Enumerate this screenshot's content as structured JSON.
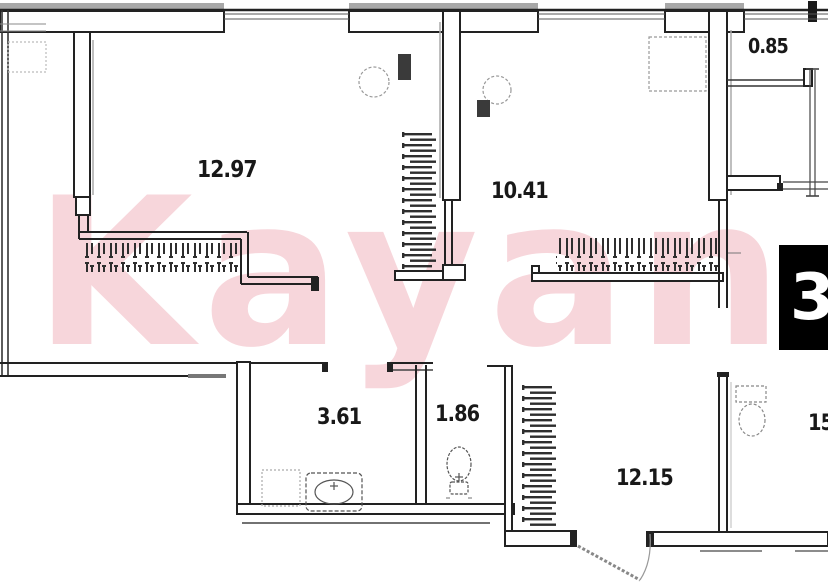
{
  "watermark": {
    "text": "Kayan",
    "color": "#f7d6db"
  },
  "unit_badge": {
    "value": "3",
    "bg": "#000000",
    "fg": "#ffffff"
  },
  "rooms": [
    {
      "id": "room-top-left",
      "area": "12.97"
    },
    {
      "id": "room-top-middle",
      "area": "10.41"
    },
    {
      "id": "balcony-top-right",
      "area": "0.85"
    },
    {
      "id": "bathroom",
      "area": "3.61"
    },
    {
      "id": "wc",
      "area": "1.86"
    },
    {
      "id": "hallway",
      "area": "12.15"
    },
    {
      "id": "room-right-cropped",
      "area": "15"
    }
  ],
  "symbols": [
    "wardrobe-hatch",
    "toilet-symbol",
    "sink-symbol",
    "washer-symbol",
    "door-swing-symbol",
    "window-lines",
    "wall-pier"
  ],
  "colors": {
    "wall": "#222222",
    "hatch": "#2e2e2e",
    "fixture": "#8a8a8a",
    "shadow": "#aaaaaa",
    "watermark": "#f7d6db",
    "badge_bg": "#000000",
    "badge_fg": "#ffffff"
  }
}
